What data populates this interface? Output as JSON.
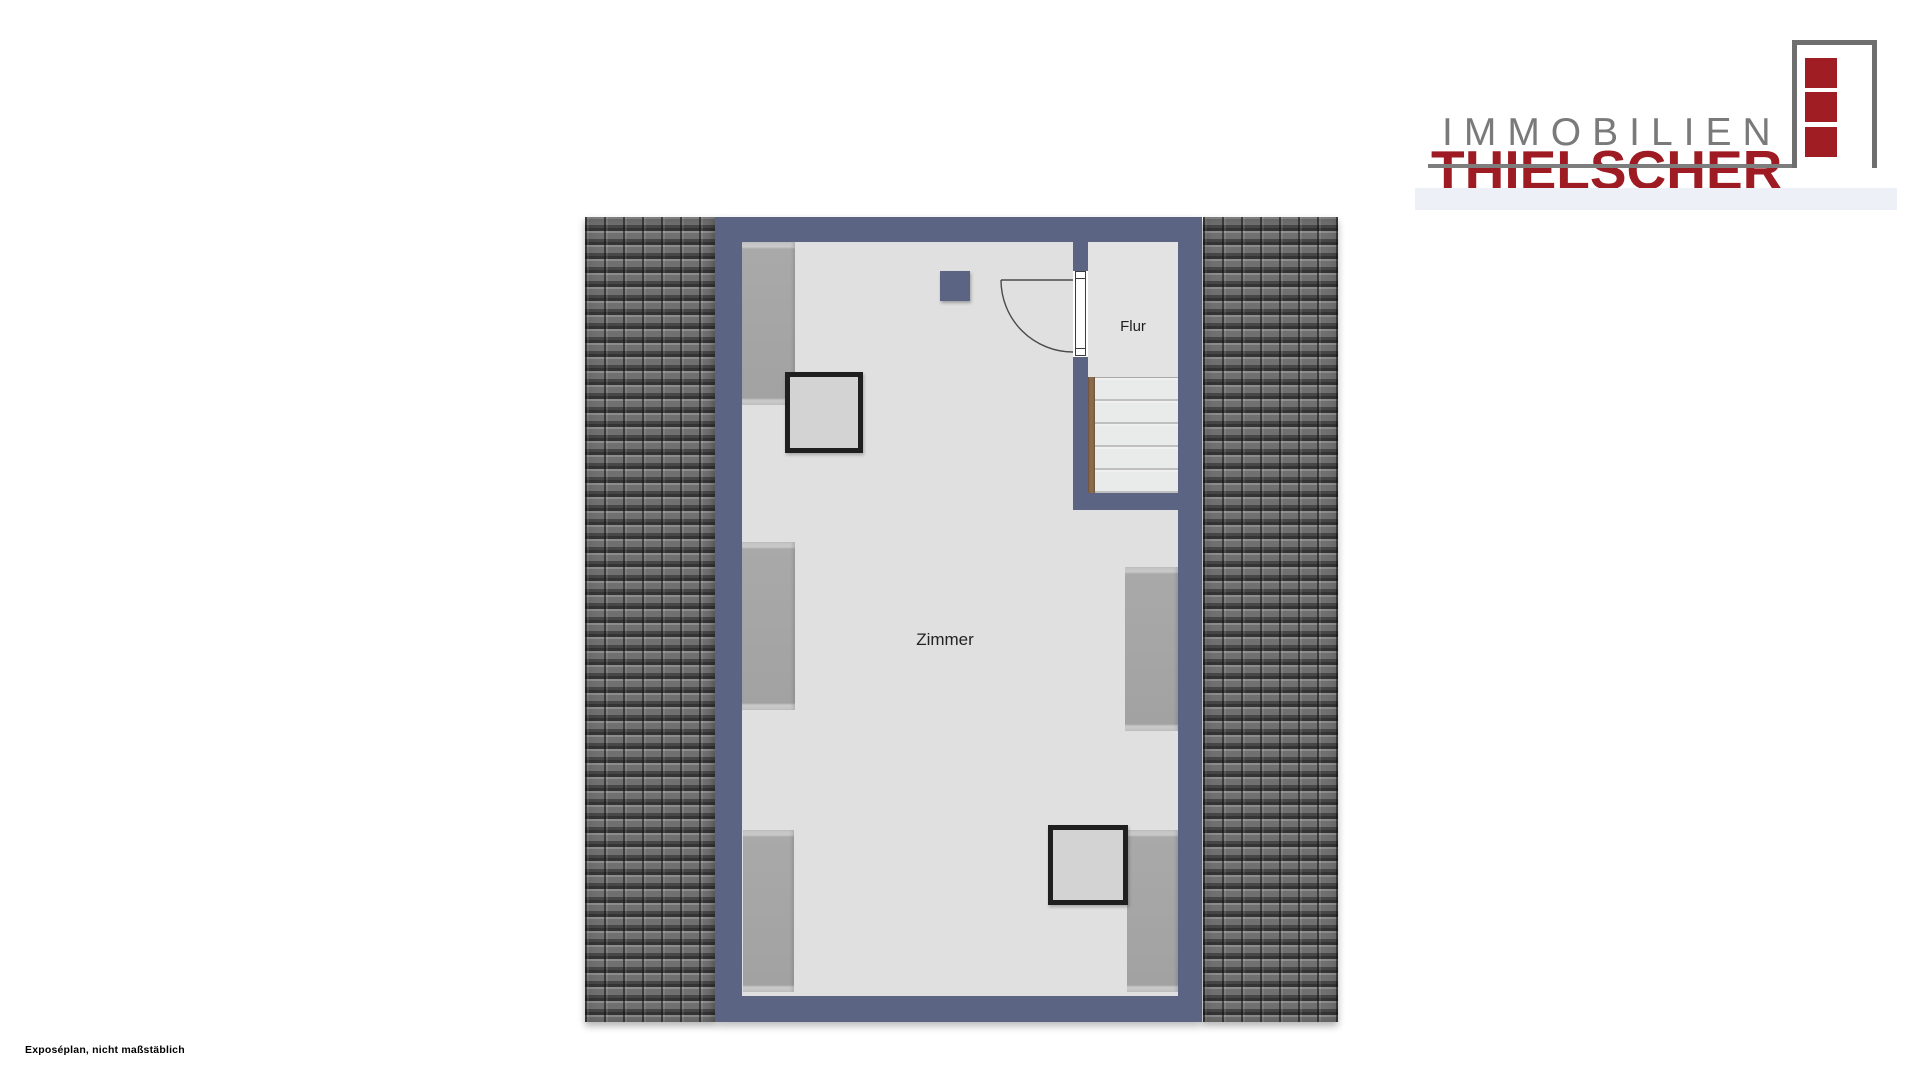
{
  "logo": {
    "line1": "IMMOBILIEN",
    "line2": "THIELSCHER",
    "colors": {
      "line1_text": "#7a7a7a",
      "line2_text": "#9e1b23",
      "icon_squares": "#a01d24",
      "icon_frame": "#6f6f6f",
      "accent_band": "#edf1f7"
    }
  },
  "floorplan": {
    "rooms": [
      {
        "name": "Zimmer"
      },
      {
        "name": "Flur"
      }
    ],
    "stairs": {
      "treads": 5,
      "stringer_color": "#8a6a4c"
    },
    "colors": {
      "wall": "#5b6583",
      "zimmer_floor": "#e0e0e0",
      "flur_floor": "#e3e3e3",
      "roof_tiles": "#707070",
      "furniture": "#a9a9a9"
    }
  },
  "footer": {
    "note": "Exposéplan, nicht maßstäblich"
  }
}
